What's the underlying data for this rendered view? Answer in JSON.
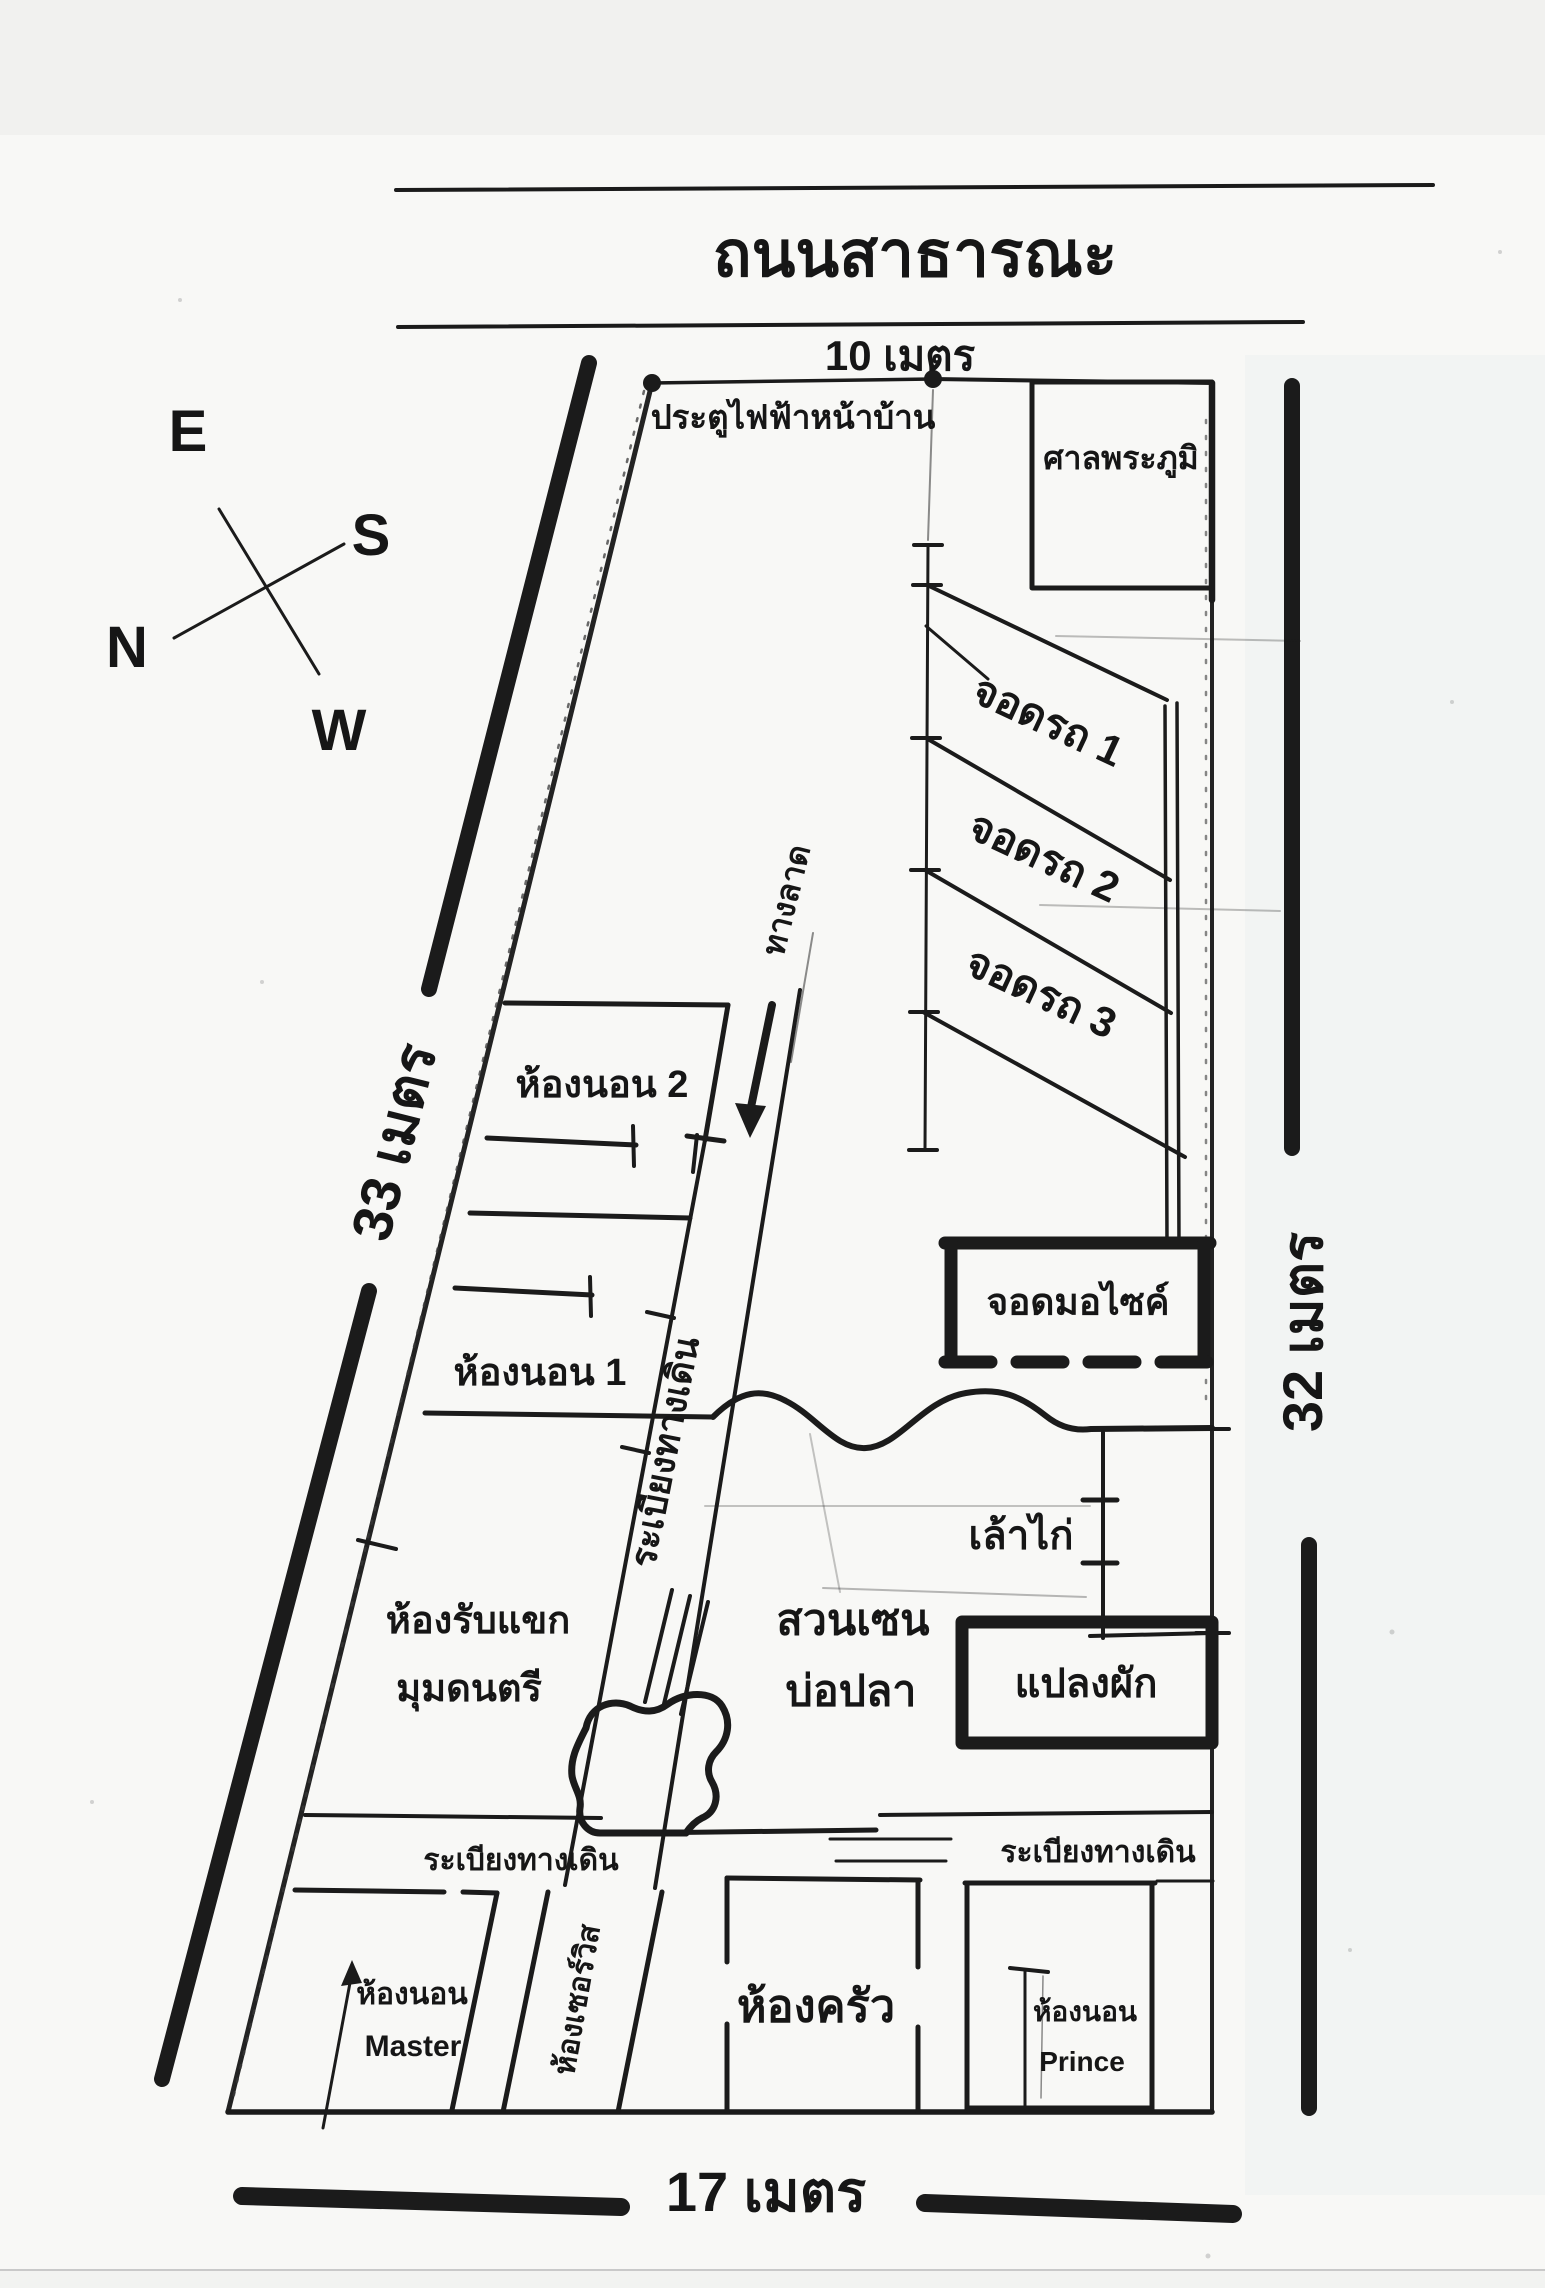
{
  "canvas": {
    "width": 1545,
    "height": 2288,
    "paper": "#f8f8f6",
    "ink": "#1b1b1b"
  },
  "road": {
    "title": "ถนนสาธารณะ",
    "width_label": "10 เมตร"
  },
  "compass": {
    "east": "E",
    "south": "S",
    "north": "N",
    "west": "W"
  },
  "dimensions": {
    "left_side": "33 เมตร",
    "right_side": "32 เมตร",
    "bottom_side": "17 เมตร"
  },
  "site": {
    "gate_label": "ประตูไฟฟ้าหน้าบ้าน",
    "spirit_house": "ศาลพระภูมิ",
    "parking_1": "จอดรถ 1",
    "parking_2": "จอดรถ 2",
    "parking_3": "จอดรถ 3",
    "ramp": "ทางลาด",
    "motorcycle_parking": "จอดมอไซค์",
    "chicken_coop": "เล้าไก่",
    "vegetable_plot": "แปลงผัก",
    "zen_garden_line1": "สวนเซน",
    "zen_garden_line2": "บ่อปลา",
    "walkway_diagonal": "ระเบียงทางเดิน",
    "walkway_left": "ระเบียงทางเดิน",
    "walkway_right": "ระเบียงทางเดิน"
  },
  "house": {
    "bedroom_2": "ห้องนอน 2",
    "bedroom_1": "ห้องนอน 1",
    "living_room_line1": "ห้องรับแขก",
    "living_room_line2": "มุมดนตรี",
    "master_bedroom_line1": "ห้องนอน",
    "master_bedroom_line2": "Master",
    "service_room": "ห้องเซอร์วิส",
    "kitchen": "ห้องครัว",
    "prince_bedroom_line1": "ห้องนอน",
    "prince_bedroom_line2": "Prince"
  }
}
